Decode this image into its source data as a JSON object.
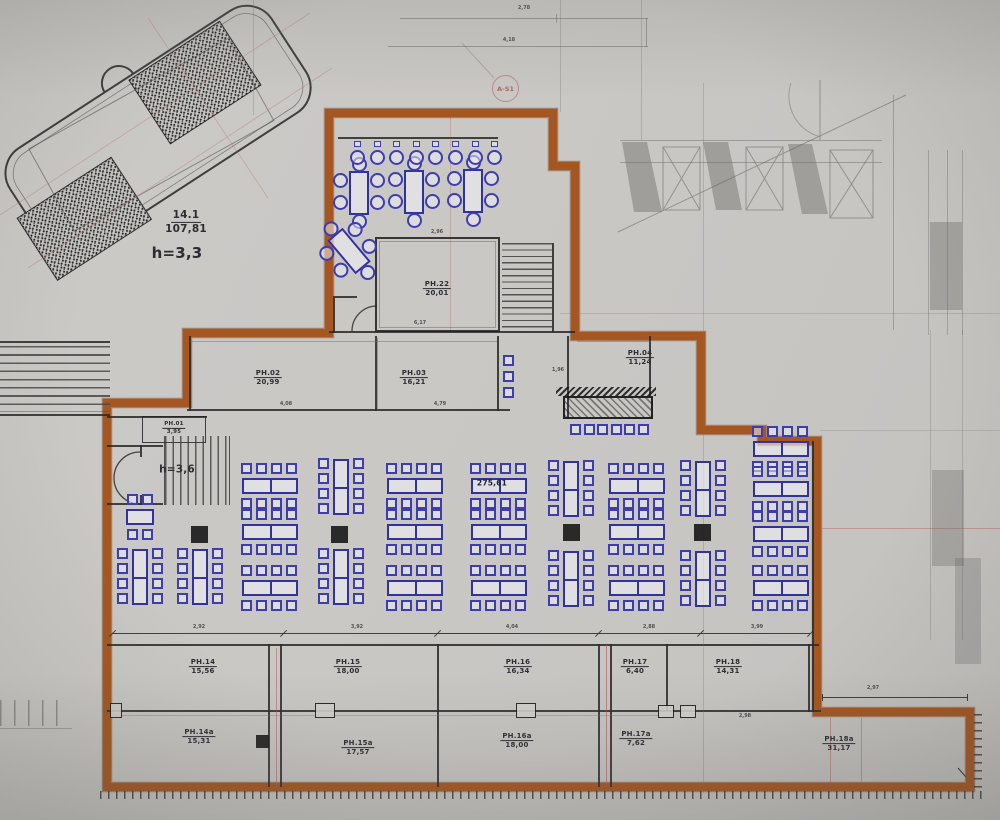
{
  "title": "Floor plan drawing",
  "colors": {
    "background": "#c9c7c4",
    "boundary_orange": "#a6541e",
    "furniture_blue": "#3a3aae",
    "wall_black": "#2c2c2c",
    "accent_red": "#b05555"
  },
  "unit_label": {
    "code": "14.1",
    "area": "107,81",
    "height": "h=3,3"
  },
  "hall": {
    "area": "275,61",
    "height": "h=3,6"
  },
  "section_marker": "A-S1",
  "rooms": [
    {
      "id": "ph22",
      "code": "PH.22",
      "area": "20,01",
      "x": 437,
      "y": 289
    },
    {
      "id": "ph02",
      "code": "PH.02",
      "area": "20,99",
      "x": 268,
      "y": 378
    },
    {
      "id": "ph03",
      "code": "PH.03",
      "area": "16,21",
      "x": 414,
      "y": 378
    },
    {
      "id": "ph04",
      "code": "PH.04",
      "area": "11,24",
      "x": 640,
      "y": 358
    },
    {
      "id": "ph01",
      "code": "PH.01",
      "area": "3,95",
      "x": 174,
      "y": 428,
      "small": true
    },
    {
      "id": "ph14",
      "code": "PH.14",
      "area": "15,56",
      "x": 203,
      "y": 667
    },
    {
      "id": "ph15",
      "code": "PH.15",
      "area": "18,00",
      "x": 348,
      "y": 667
    },
    {
      "id": "ph16",
      "code": "PH.16",
      "area": "16,34",
      "x": 518,
      "y": 667
    },
    {
      "id": "ph17",
      "code": "PH.17",
      "area": "6,40",
      "x": 635,
      "y": 667
    },
    {
      "id": "ph18",
      "code": "PH.18",
      "area": "14,31",
      "x": 728,
      "y": 667
    },
    {
      "id": "ph14a",
      "code": "PH.14a",
      "area": "15,31",
      "x": 199,
      "y": 737
    },
    {
      "id": "ph15a",
      "code": "PH.15a",
      "area": "17,57",
      "x": 358,
      "y": 748
    },
    {
      "id": "ph16a",
      "code": "PH.16a",
      "area": "18,00",
      "x": 517,
      "y": 741
    },
    {
      "id": "ph17a",
      "code": "PH.17a",
      "area": "7,62",
      "x": 636,
      "y": 739
    },
    {
      "id": "ph18a",
      "code": "PH.18a",
      "area": "31,17",
      "x": 839,
      "y": 744
    }
  ],
  "dimensions": [
    {
      "text": "2,78",
      "x": 524,
      "y": 8
    },
    {
      "text": "4,18",
      "x": 509,
      "y": 40
    },
    {
      "text": "2,96",
      "x": 437,
      "y": 232
    },
    {
      "text": "6,17",
      "x": 420,
      "y": 323
    },
    {
      "text": "4,08",
      "x": 286,
      "y": 404
    },
    {
      "text": "4,79",
      "x": 440,
      "y": 404
    },
    {
      "text": "1,96",
      "x": 558,
      "y": 370
    },
    {
      "text": "2,92",
      "x": 199,
      "y": 627
    },
    {
      "text": "3,92",
      "x": 357,
      "y": 627
    },
    {
      "text": "4,04",
      "x": 512,
      "y": 627
    },
    {
      "text": "2,88",
      "x": 649,
      "y": 627
    },
    {
      "text": "3,99",
      "x": 757,
      "y": 627
    },
    {
      "text": "2,98",
      "x": 745,
      "y": 716
    },
    {
      "text": "2,97",
      "x": 873,
      "y": 688
    }
  ],
  "furniture": {
    "h_clusters": [
      [
        270,
        486
      ],
      [
        415,
        486
      ],
      [
        499,
        486
      ],
      [
        637,
        486
      ],
      [
        270,
        532
      ],
      [
        415,
        532
      ],
      [
        499,
        532
      ],
      [
        637,
        532
      ],
      [
        270,
        588
      ],
      [
        415,
        588
      ],
      [
        499,
        588
      ],
      [
        637,
        588
      ],
      [
        781,
        449
      ],
      [
        781,
        489
      ],
      [
        781,
        534
      ],
      [
        781,
        588
      ]
    ],
    "v_clusters": [
      [
        341,
        487
      ],
      [
        571,
        489
      ],
      [
        703,
        489
      ],
      [
        341,
        577
      ],
      [
        571,
        579
      ],
      [
        703,
        579
      ],
      [
        140,
        577
      ],
      [
        200,
        577
      ]
    ],
    "small_clusters": [
      [
        140,
        517
      ]
    ],
    "round_groups": [
      [
        359,
        193,
        0
      ],
      [
        414,
        192,
        0
      ],
      [
        473,
        191,
        0
      ],
      [
        349,
        251,
        -40
      ]
    ],
    "bar_stools": {
      "x0": 350,
      "y": 150,
      "dx": 19.6,
      "count": 8
    },
    "stage_chair_row": {
      "x0": 570,
      "y": 424,
      "dx": 13.5,
      "count": 6
    },
    "corridor_chair_col": {
      "x": 503,
      "y0": 355,
      "dy": 16,
      "count": 3
    },
    "pillars": [
      [
        199,
        534
      ],
      [
        339,
        534
      ],
      [
        571,
        532
      ],
      [
        702,
        532
      ]
    ]
  }
}
